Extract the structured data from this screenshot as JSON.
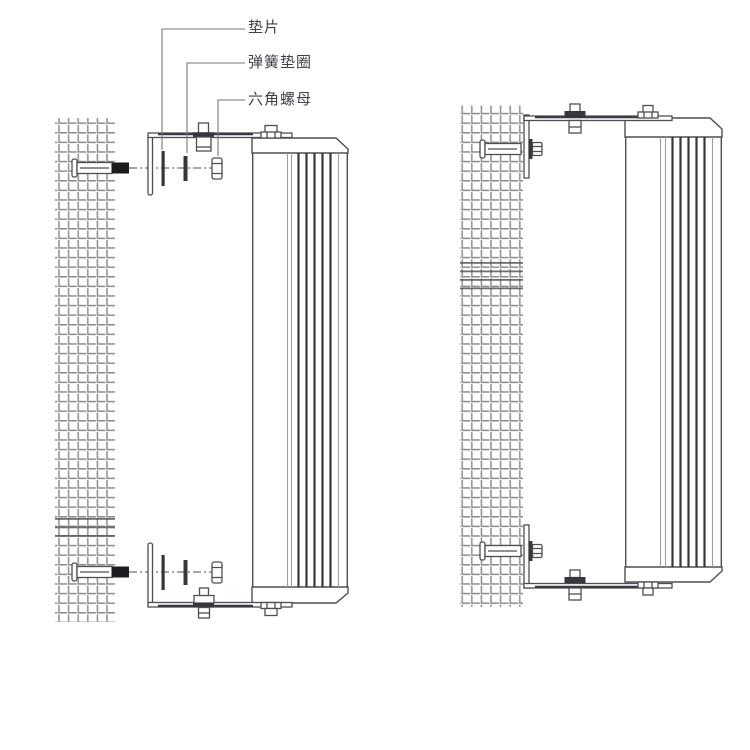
{
  "diagram": {
    "type": "speaker-wall-mount-installation-diagram",
    "callouts": [
      {
        "id": "flat-washer",
        "text": "垫片"
      },
      {
        "id": "spring-washer",
        "text": "弹簧垫圈"
      },
      {
        "id": "hex-nut",
        "text": "六角螺母"
      }
    ],
    "views": [
      {
        "id": "left",
        "name": "exploded-mounting-view"
      },
      {
        "id": "right",
        "name": "assembled-mounting-view"
      }
    ]
  },
  "colors": {
    "background": "#ffffff",
    "line": "#4b4f55",
    "dark_line": "#34373c",
    "fill_black": "#1b1d20",
    "wall_hatch": "#8a8d92",
    "leader": "#73767b",
    "text": "#3c4147"
  }
}
